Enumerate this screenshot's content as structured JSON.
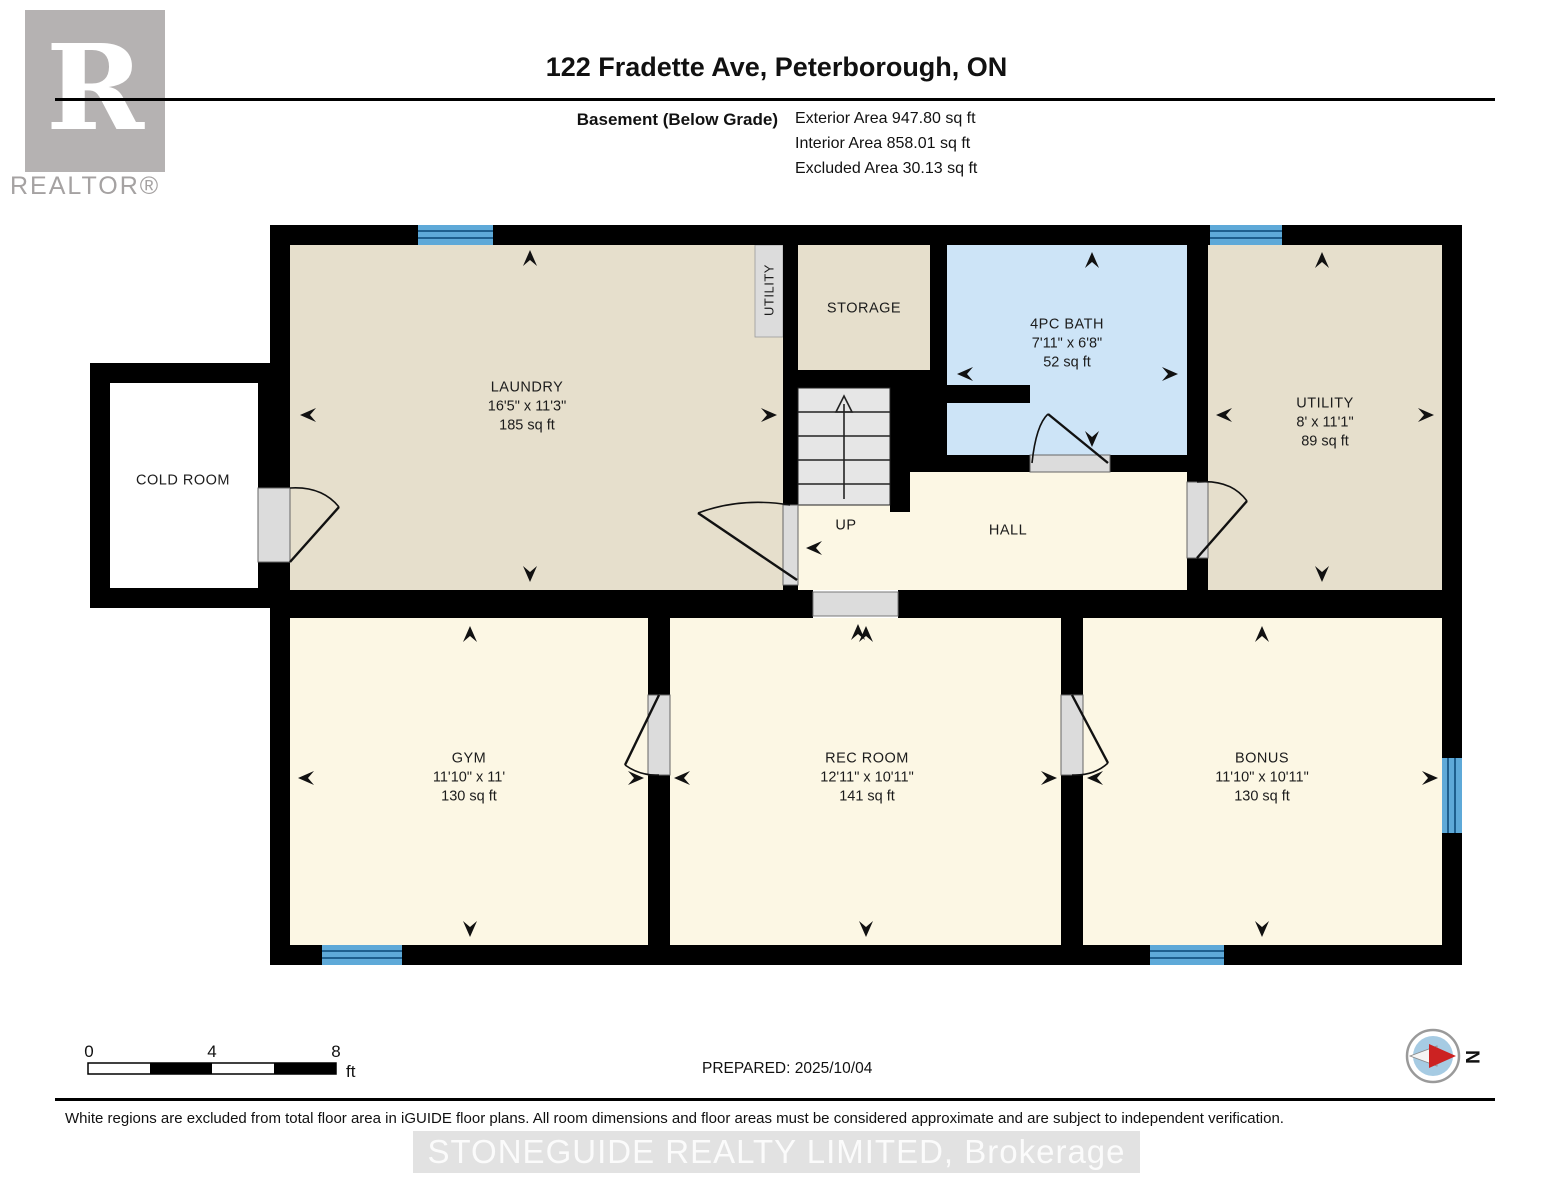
{
  "header": {
    "title": "122 Fradette Ave, Peterborough, ON",
    "floor_label": "Basement (Below Grade)",
    "areas": [
      "Exterior Area 947.80 sq ft",
      "Interior Area 858.01 sq ft",
      "Excluded Area 30.13 sq ft"
    ],
    "brand": {
      "logo_letter": "R",
      "logo_text": "REALTOR®"
    }
  },
  "rooms": {
    "cold_room": {
      "name": "COLD ROOM"
    },
    "laundry": {
      "name": "LAUNDRY",
      "dims": "16'5\" x 11'3\"",
      "area": "185 sq ft"
    },
    "utility_closet": {
      "name": "UTILITY"
    },
    "storage": {
      "name": "STORAGE"
    },
    "bath": {
      "name": "4PC BATH",
      "dims": "7'11\" x 6'8\"",
      "area": "52 sq ft"
    },
    "utility": {
      "name": "UTILITY",
      "dims": "8' x 11'1\"",
      "area": "89 sq ft"
    },
    "up": {
      "name": "UP"
    },
    "hall": {
      "name": "HALL"
    },
    "gym": {
      "name": "GYM",
      "dims": "11'10\" x 11'",
      "area": "130 sq ft"
    },
    "rec_room": {
      "name": "REC ROOM",
      "dims": "12'11\" x 10'11\"",
      "area": "141 sq ft"
    },
    "bonus": {
      "name": "BONUS",
      "dims": "11'10\" x 10'11\"",
      "area": "130 sq ft"
    }
  },
  "footer": {
    "scale_start": "0",
    "scale_mid": "4",
    "scale_end": "8",
    "scale_unit": "ft",
    "prepared": "PREPARED: 2025/10/04",
    "compass_label": "N",
    "disclaimer": "White regions are excluded from total floor area in iGUIDE floor plans. All room dimensions and floor areas must be considered approximate and are subject to independent verification.",
    "watermark": "STONEGUIDE REALTY LIMITED, Brokerage"
  },
  "colors": {
    "wall": "#000000",
    "room_beige": "#e6dfcc",
    "room_cream": "#fcf7e4",
    "room_blue": "#cde4f7",
    "window_blue": "#5ea9d8",
    "stair_gray": "#e6e6e6",
    "door_gray": "#dcdcdc",
    "watermark_gray": "#e2e2e2",
    "logo_gray": "#b5b2b2",
    "compass_red": "#cc2222",
    "compass_fill": "#a6cbe3"
  }
}
